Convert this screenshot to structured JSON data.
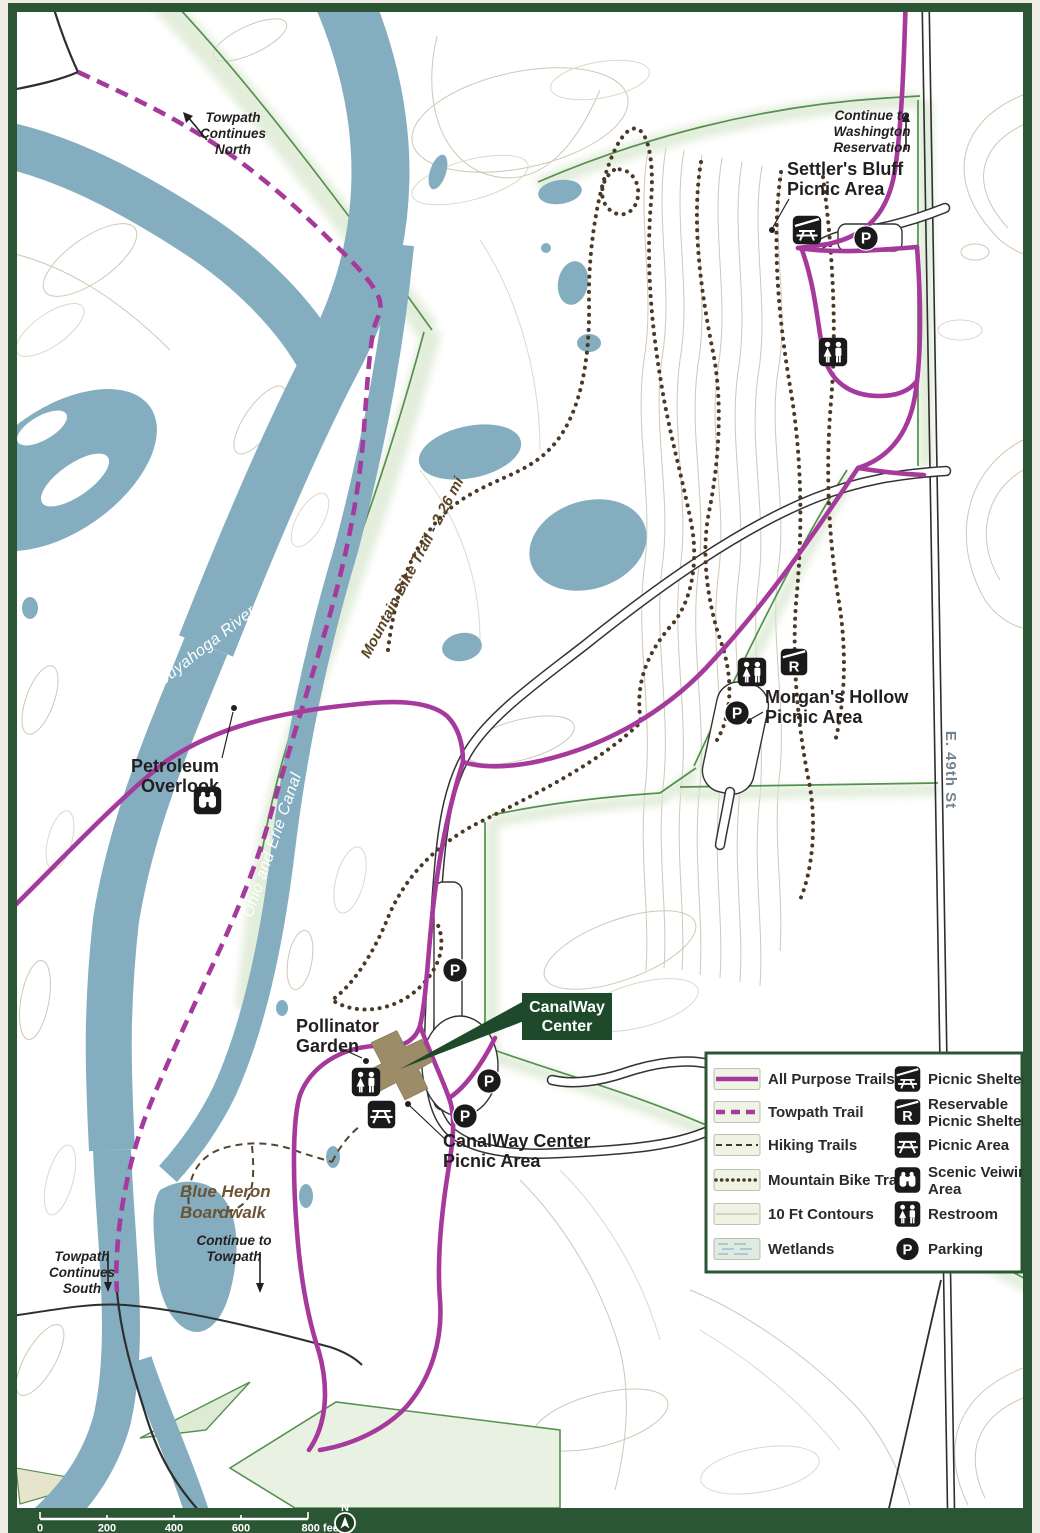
{
  "map_labels": {
    "towpath_continues_north": {
      "line1": "Towpath",
      "line2": "Continues",
      "line3": "North"
    },
    "continue_washington": {
      "line1": "Continue to",
      "line2": "Washington",
      "line3": "Reservation"
    },
    "settlers_bluff_picnic_area": {
      "line1": "Settler's Bluff",
      "line2": "Picnic Area"
    },
    "morgans_hollow_picnic_area": {
      "line1": "Morgan's Hollow",
      "line2": "Picnic Area"
    },
    "petroleum_overlook": {
      "line1": "Petroleum",
      "line2": "Overlook"
    },
    "pollinator_garden": {
      "line1": "Pollinator",
      "line2": "Garden"
    },
    "canalway_center": {
      "line1": "CanalWay",
      "line2": "Center"
    },
    "canalway_center_picnic_area": {
      "line1": "CanalWay Center",
      "line2": "Picnic Area"
    },
    "blue_heron_boardwalk": {
      "line1": "Blue Heron",
      "line2": "Boardwalk"
    },
    "continue_to_towpath": {
      "line1": "Continue to",
      "line2": "Towpath"
    },
    "towpath_continues_south": {
      "line1": "Towpath",
      "line2": "Continues",
      "line3": "South"
    },
    "cuyahoga_river": "Cuyahoga River",
    "ohio_and_erie_canal": "Ohio and Erie Canal",
    "mountain_bike_trail": "Mountain Bike Trail - 2.26 mi",
    "e_49th_st": "E. 49th St"
  },
  "icons": {
    "parking_glyph": "P",
    "reservable_glyph": "R"
  },
  "legend": {
    "line_items": [
      {
        "label": "All Purpose Trails"
      },
      {
        "label": "Towpath Trail"
      },
      {
        "label": "Hiking Trails"
      },
      {
        "label": "Mountain Bike Trails"
      },
      {
        "label": "10 Ft Contours"
      },
      {
        "label": "Wetlands"
      }
    ],
    "icon_items": [
      {
        "line1": "Picnic Shelter",
        "line2": ""
      },
      {
        "line1": "Reservable",
        "line2": "Picnic Shelter"
      },
      {
        "line1": "Picnic Area",
        "line2": ""
      },
      {
        "line1": "Scenic Veiwing",
        "line2": "Area"
      },
      {
        "line1": "Restroom",
        "line2": ""
      },
      {
        "line1": "Parking",
        "line2": ""
      }
    ]
  },
  "scale_bar": {
    "ticks": [
      "0",
      "200",
      "400",
      "600",
      "800 feet"
    ],
    "north_label": "N"
  },
  "colors": {
    "frame_green": "#2B5633",
    "trail_purple": "#A63A9C",
    "water_blue": "#84AEC0",
    "boundary_green": "#55904E",
    "building_brown": "#9C8C68",
    "callout_green": "#1E4A2B",
    "icon_black": "#1A1A1A"
  }
}
